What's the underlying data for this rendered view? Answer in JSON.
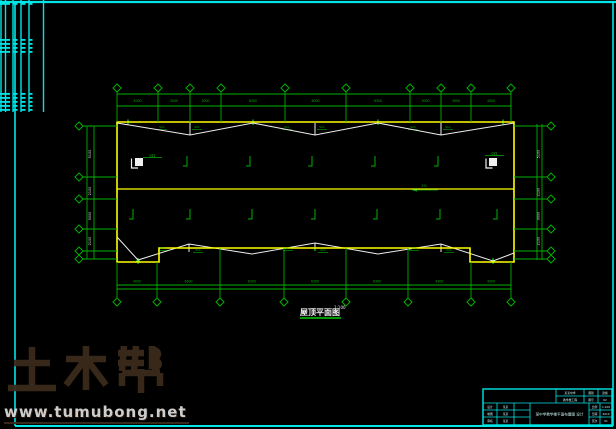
{
  "colors": {
    "background": "#000000",
    "frame_cyan": "#00E6E6",
    "grid_green": "#00AF00",
    "bright_green": "#19FF19",
    "outline_yellow": "#FFFF00",
    "brace_white": "#EFEFEF",
    "text_cyan": "#C8EFEF",
    "watermark_brown": "#3A2B1C",
    "watermark_url_gray": "#D8D8D8"
  },
  "watermark": {
    "brand": "土木帮",
    "url": "www.tumubong.net"
  },
  "plan": {
    "caption": "屋顶平面图",
    "caption_scale": "1:100",
    "slope_label": "2%",
    "column_label": "GZ1",
    "brace_label": "SC1",
    "top_dims": [
      "4000",
      "3000",
      "3000",
      "6300",
      "6000",
      "6300",
      "3000",
      "3000",
      "4000"
    ],
    "bottom_dims": [
      "4000",
      "6300",
      "6300",
      "6300",
      "6300",
      "6300",
      "4000"
    ],
    "left_dims": [
      "5100",
      "2100",
      "3000",
      "2100"
    ],
    "right_dims": [
      "5100",
      "2100",
      "3000",
      "2100"
    ]
  },
  "title_block": {
    "title": "某中学教学楼平面布置图 设计",
    "top_cells": [
      "某某中学",
      "图别",
      "建施",
      "教学楼工程",
      "图号",
      "02"
    ],
    "left_rows": [
      [
        "设计",
        "某某"
      ],
      [
        "制图",
        "某某"
      ],
      [
        "审核",
        "某某"
      ]
    ],
    "right_rows": [
      [
        "比例",
        "1:100"
      ],
      [
        "日期",
        "2010"
      ],
      [
        "页次",
        "01"
      ]
    ]
  }
}
